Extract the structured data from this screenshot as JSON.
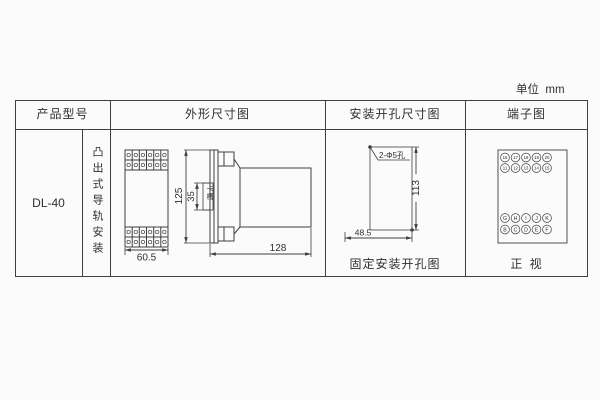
{
  "unit_label": "单位  mm",
  "table": {
    "header_product": "产品型号",
    "header_outline": "外形尺寸图",
    "header_install": "安装开孔尺寸图",
    "header_terminal": "端子图",
    "product_model": "DL-40",
    "mount_type": "凸出式导轨安装"
  },
  "outline_drawing": {
    "front_width": "60.5",
    "panel_height": "125",
    "slot_height": "35",
    "slot_label": "卡槽",
    "depth": "128"
  },
  "install_drawing": {
    "hole_note": "2-Φ5孔",
    "vertical_spacing": "113",
    "horizontal_spacing": "48.5",
    "caption": "固定安装开孔图"
  },
  "terminal_drawing": {
    "caption": "正 视",
    "row_top_1": [
      "16",
      "17",
      "18",
      "19",
      "20"
    ],
    "row_top_2": [
      "11",
      "12",
      "13",
      "14",
      "15"
    ],
    "row_bottom_1": [
      "G",
      "H",
      "I",
      "J",
      "K"
    ],
    "row_bottom_2": [
      "B",
      "C",
      "D",
      "E",
      "F"
    ]
  },
  "colors": {
    "line": "#3f3f3f",
    "text": "#2f2f2f",
    "background": "#fbfbfb"
  }
}
